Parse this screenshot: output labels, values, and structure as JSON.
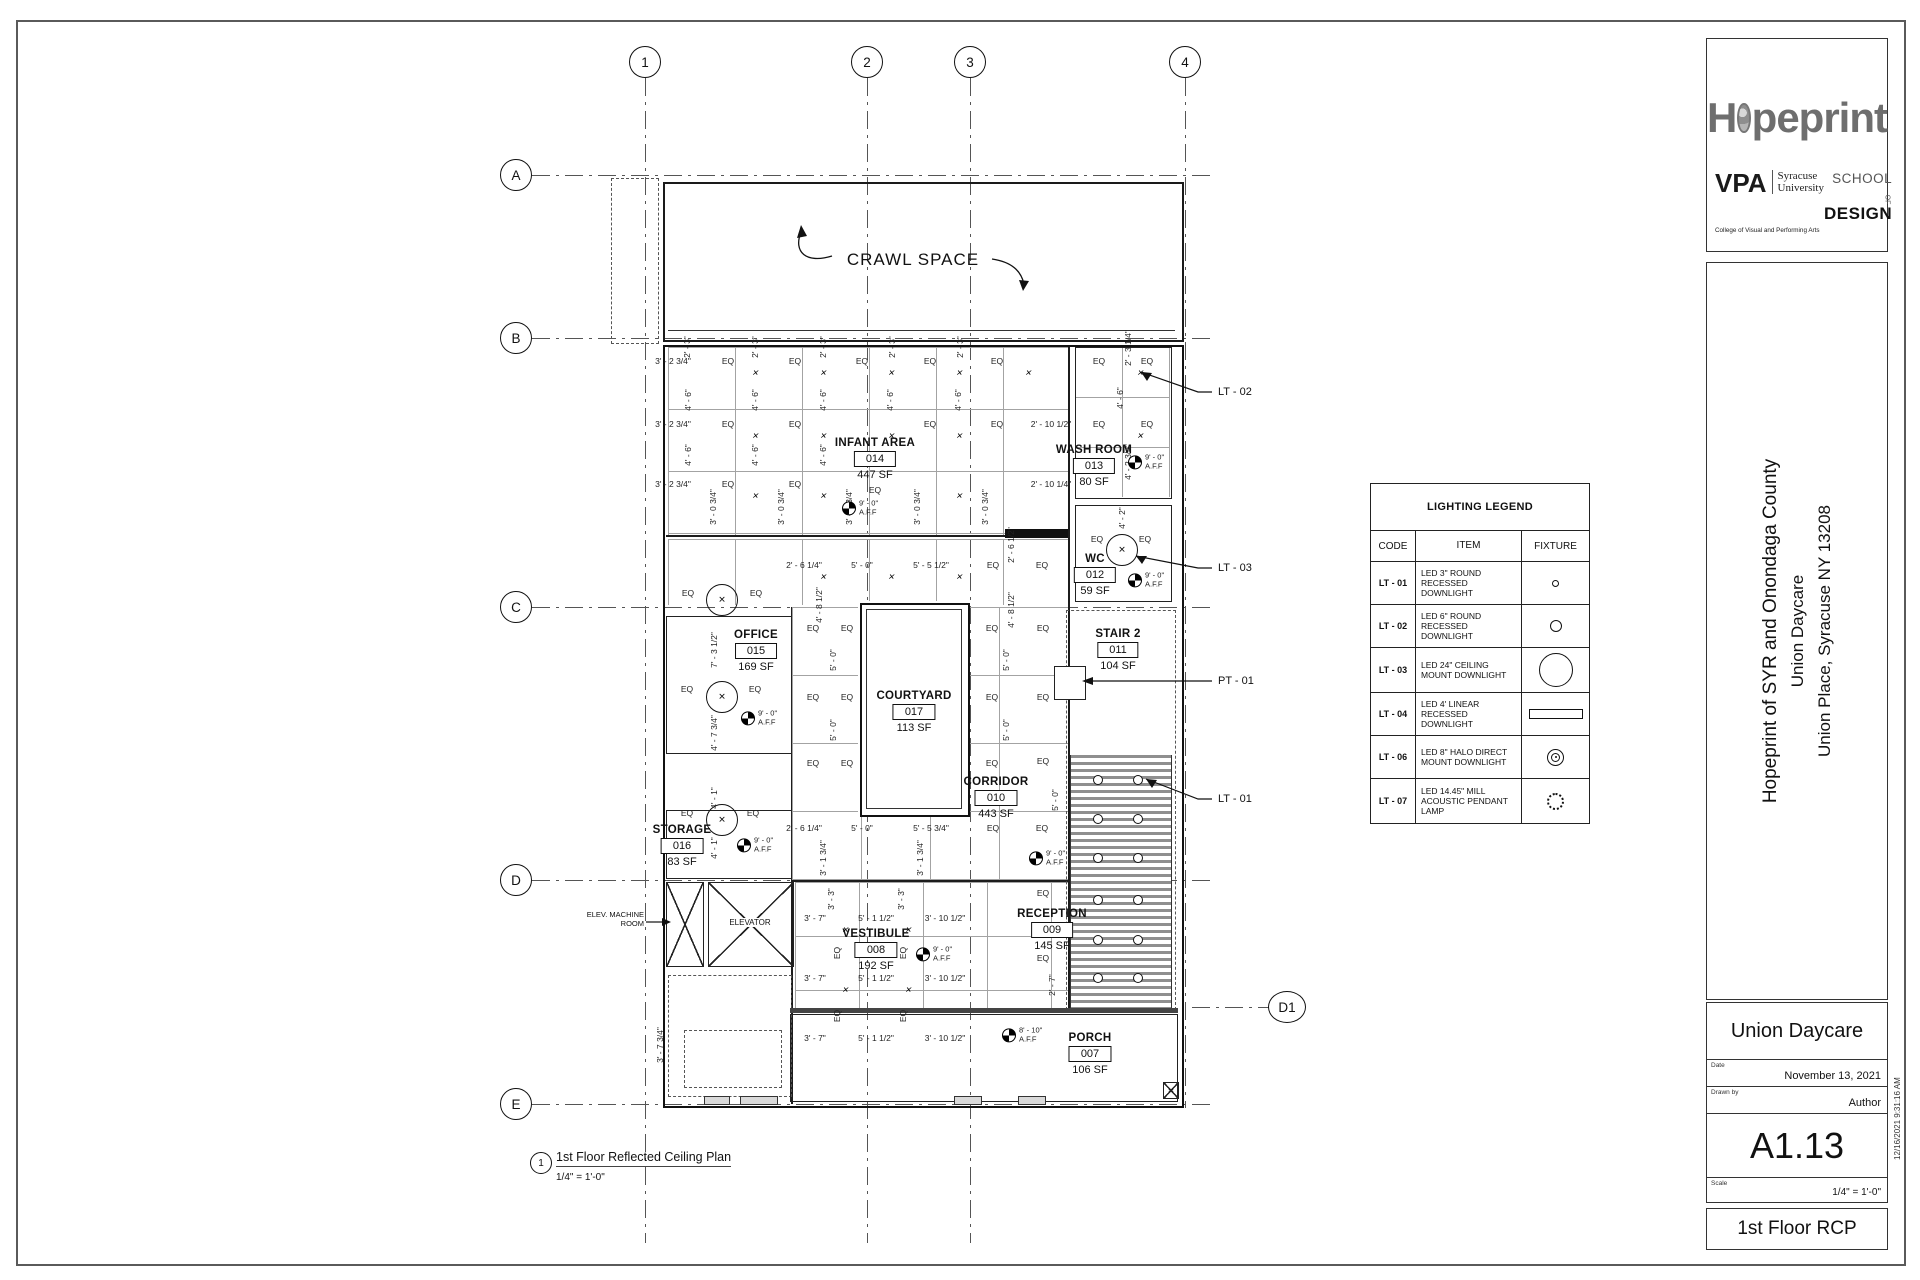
{
  "sheet": {
    "brand_h": "H",
    "brand_rest": "peprint",
    "vpa": "VPA",
    "uni1": "Syracuse",
    "uni2": "University",
    "college": "College of Visual and Performing Arts",
    "school1": "SCHOOL",
    "school_of": "OF",
    "school2": "DESIGN",
    "project1": "Hopeprint of SYR and Onondaga County",
    "project2": "Union Daycare",
    "project3": "Union Place, Syracuse NY 13208",
    "client": "Union Daycare",
    "date_label": "Date",
    "date_value": "November 13, 2021",
    "drawn_label": "Drawn by",
    "drawn_value": "Author",
    "sheet_number": "A1.13",
    "scale_label": "Scale",
    "scale_value": "1/4\" = 1'-0\"",
    "sheet_title": "1st Floor RCP",
    "timestamp": "12/16/2021 9:31:16 AM"
  },
  "legend": {
    "title": "LIGHTING LEGEND",
    "headers": [
      "CODE",
      "ITEM",
      "FIXTURE"
    ],
    "rows": [
      {
        "code": "LT - 01",
        "item": "LED 3\" ROUND RECESSED DOWNLIGHT",
        "fixture": "small-circle"
      },
      {
        "code": "LT - 02",
        "item": "LED 6\" ROUND RECESSED DOWNLIGHT",
        "fixture": "medium-circle"
      },
      {
        "code": "LT - 03",
        "item": "LED 24\" CEILING MOUNT DOWNLIGHT",
        "fixture": "large-circle"
      },
      {
        "code": "LT - 04",
        "item": "LED 4' LINEAR RECESSED DOWNLIGHT",
        "fixture": "linear-bar"
      },
      {
        "code": "LT - 06",
        "item": "LED 8\" HALO DIRECT MOUNT DOWNLIGHT",
        "fixture": "halo-circle"
      },
      {
        "code": "LT - 07",
        "item": "LED 14.45\" MILL ACOUSTIC PENDANT LAMP",
        "fixture": "pendant-gear"
      }
    ]
  },
  "plan": {
    "crawl": "CRAWL SPACE",
    "cols": [
      "1",
      "2",
      "3",
      "4"
    ],
    "rowsL": [
      "A",
      "B",
      "C",
      "D",
      "E"
    ],
    "d1": "D1",
    "rooms": [
      {
        "name": "INFANT AREA",
        "num": "014",
        "area": "447 SF"
      },
      {
        "name": "WASH ROOM",
        "num": "013",
        "area": "80 SF"
      },
      {
        "name": "WC",
        "num": "012",
        "area": "59 SF"
      },
      {
        "name": "OFFICE",
        "num": "015",
        "area": "169 SF"
      },
      {
        "name": "COURTYARD",
        "num": "017",
        "area": "113 SF"
      },
      {
        "name": "STAIR 2",
        "num": "011",
        "area": "104 SF"
      },
      {
        "name": "CORRIDOR",
        "num": "010",
        "area": "443 SF"
      },
      {
        "name": "STORAGE",
        "num": "016",
        "area": "83 SF"
      },
      {
        "name": "VESTIBULE",
        "num": "008",
        "area": "192 SF"
      },
      {
        "name": "RECEPTION",
        "num": "009",
        "area": "145 SF"
      },
      {
        "name": "PORCH",
        "num": "007",
        "area": "106 SF"
      }
    ],
    "elevator": "ELEVATOR",
    "elev_machine1": "ELEV. MACHINE",
    "elev_machine2": "ROOM",
    "callouts": {
      "lt01": "LT - 01",
      "lt02": "LT - 02",
      "lt03": "LT - 03",
      "pt01": "PT - 01"
    },
    "eq": "EQ",
    "aff9": "9' - 0\"",
    "aff810": "8' - 10\"",
    "aff_sfx": "A.F.F",
    "dims": {
      "d_3_2_34": "3' - 2 3/4\"",
      "d_3_0_34": "3' - 0 3/4\"",
      "d_2_3": "2' - 3\"",
      "d_4_6": "4' - 6\"",
      "d_2_10_12": "2' - 10 1/2\"",
      "d_2_10_14": "2' - 10 1/4\"",
      "d_2_6_14": "2' - 6 1/4\"",
      "d_2_6_12": "2' - 6 1/2\"",
      "d_5_0": "5' - 0\"",
      "d_5_5_12": "5' - 5 1/2\"",
      "d_5_5_34": "5' - 5 3/4\"",
      "d_4_8_12": "4' - 8 1/2\"",
      "d_7_3_12": "7' - 3 1/2\"",
      "d_4_7_34": "4' - 7 3/4\"",
      "d_4_1": "4' - 1\"",
      "d_3_7": "3' - 7\"",
      "d_5_1_12": "5' - 1 1/2\"",
      "d_3_10_12": "3' - 10 1/2\"",
      "d_3_3": "3' - 3\"",
      "d_3_1_34": "3' - 1 3/4\"",
      "d_4_2": "4' - 2\"",
      "d_4_2_34": "4' - 2 3/4\"",
      "d_2_3_14": "2' - 3 1/4\"",
      "d_2_7": "2' - 7\"",
      "d_3_7_34": "3' - 7 3/4\""
    },
    "view": {
      "num": "1",
      "title": "1st Floor Reflected Ceiling Plan",
      "scale": "1/4\" = 1'-0\""
    }
  }
}
